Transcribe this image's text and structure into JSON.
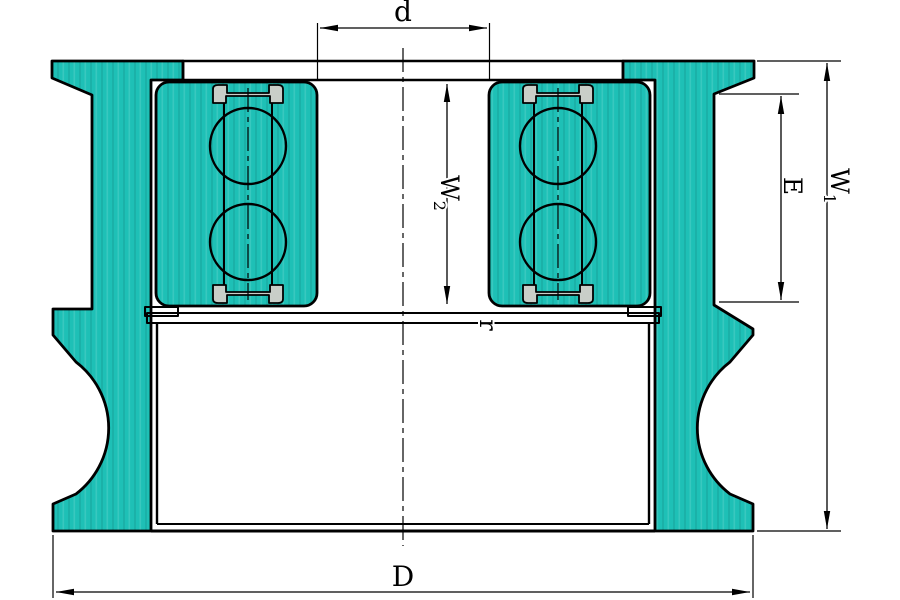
{
  "colors": {
    "part_teal": "#1ec0b6",
    "outline": "#000000",
    "seal_gray": "#c9cec8",
    "ball_white": "#ffffff",
    "background": "#ffffff"
  },
  "dims": {
    "d": {
      "label": "d"
    },
    "D": {
      "label": "D"
    },
    "E": {
      "label": "E"
    },
    "r": {
      "label": "r"
    },
    "W1": {
      "main": "W",
      "sub": "1"
    },
    "W2": {
      "main": "W",
      "sub": "2"
    }
  }
}
